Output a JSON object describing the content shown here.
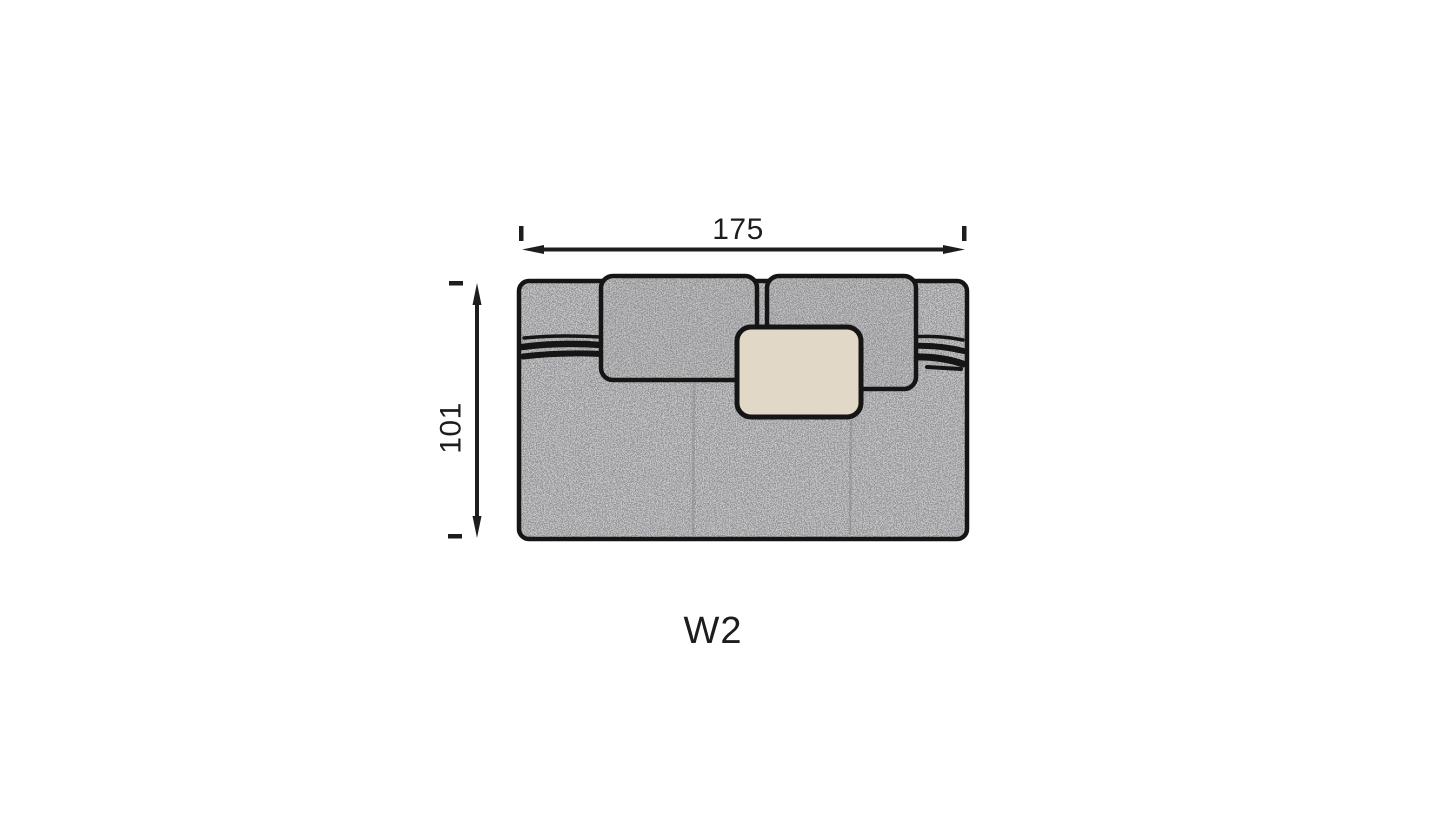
{
  "diagram": {
    "module_label": "W2",
    "dimensions": {
      "width": {
        "value": "175"
      },
      "depth": {
        "value": "101"
      }
    },
    "colors": {
      "background": "#ffffff",
      "fabric_grey": "#c2c2c2",
      "cushion_grey": "#bdbdbd",
      "pillow_beige": "#e2d8c7",
      "outline": "#151515",
      "dimension": "#1d1d1d",
      "seam": "#6f6f6f"
    },
    "parts": {
      "body": "sofa-module-top-view",
      "back_cushion_left": "back-cushion-left",
      "back_cushion_right": "back-cushion-right",
      "throw_pillow": "throw-pillow",
      "back_piping_band": "back-piping-band"
    }
  }
}
